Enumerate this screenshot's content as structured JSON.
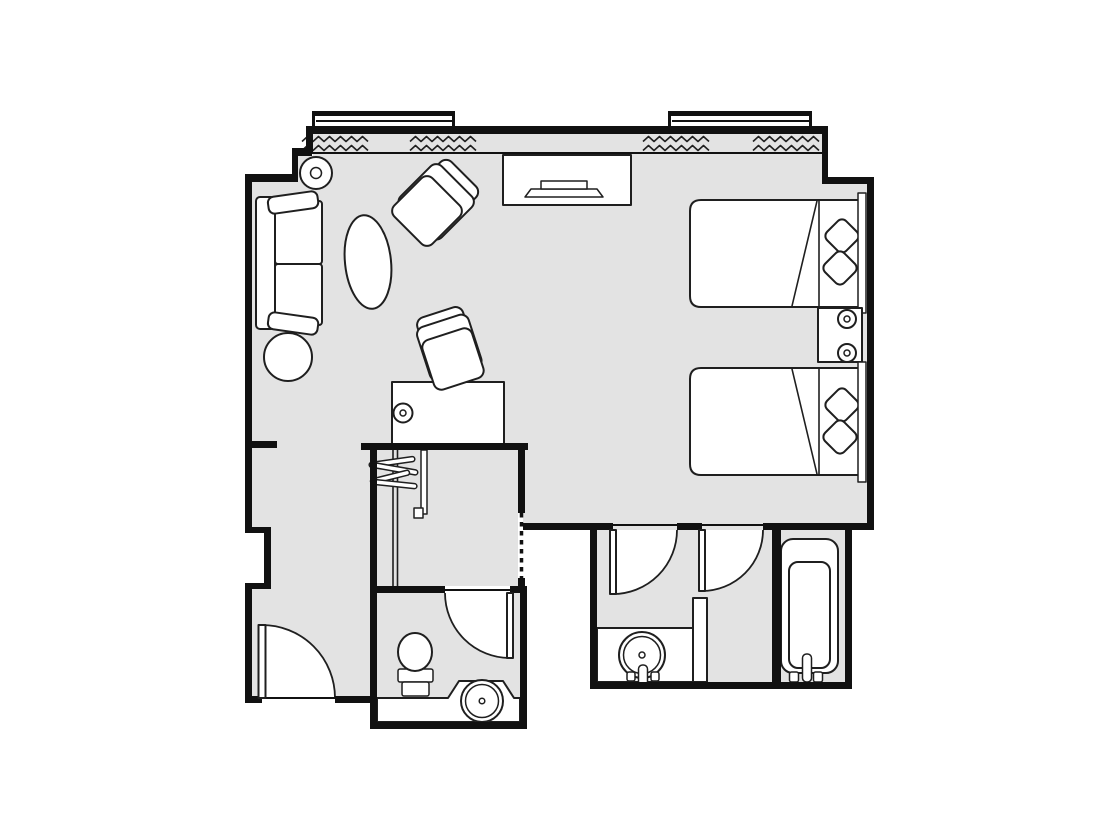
{
  "colors": {
    "background": "#ffffff",
    "floor": "#e3e3e3",
    "wall": "#111111",
    "line": "#1f1f1f",
    "fixture": "#ffffff"
  },
  "floorplan": {
    "kind": "hotel-room-floor-plan",
    "rooms": [
      {
        "name": "living-area"
      },
      {
        "name": "bedroom-area"
      },
      {
        "name": "entry-hall"
      },
      {
        "name": "closet"
      },
      {
        "name": "bathroom-center"
      },
      {
        "name": "bathroom-right"
      },
      {
        "name": "bathtub-niche"
      }
    ],
    "window_bays": 2,
    "curtain_runs": 4,
    "door_swings": 4,
    "furniture": [
      "sofa",
      "oval-coffee-table",
      "armchair",
      "round-side-table",
      "floor-lamp",
      "tv-console",
      "television",
      "desk",
      "desk-chair",
      "desk-lamp",
      "bed",
      "bed",
      "nightstand",
      "table-lamp",
      "table-lamp",
      "pillow",
      "pillow",
      "pillow",
      "pillow",
      "clothes-hangers"
    ],
    "fixtures": [
      "toilet",
      "washbasin-round",
      "washbasin-vanity",
      "bathtub"
    ]
  }
}
